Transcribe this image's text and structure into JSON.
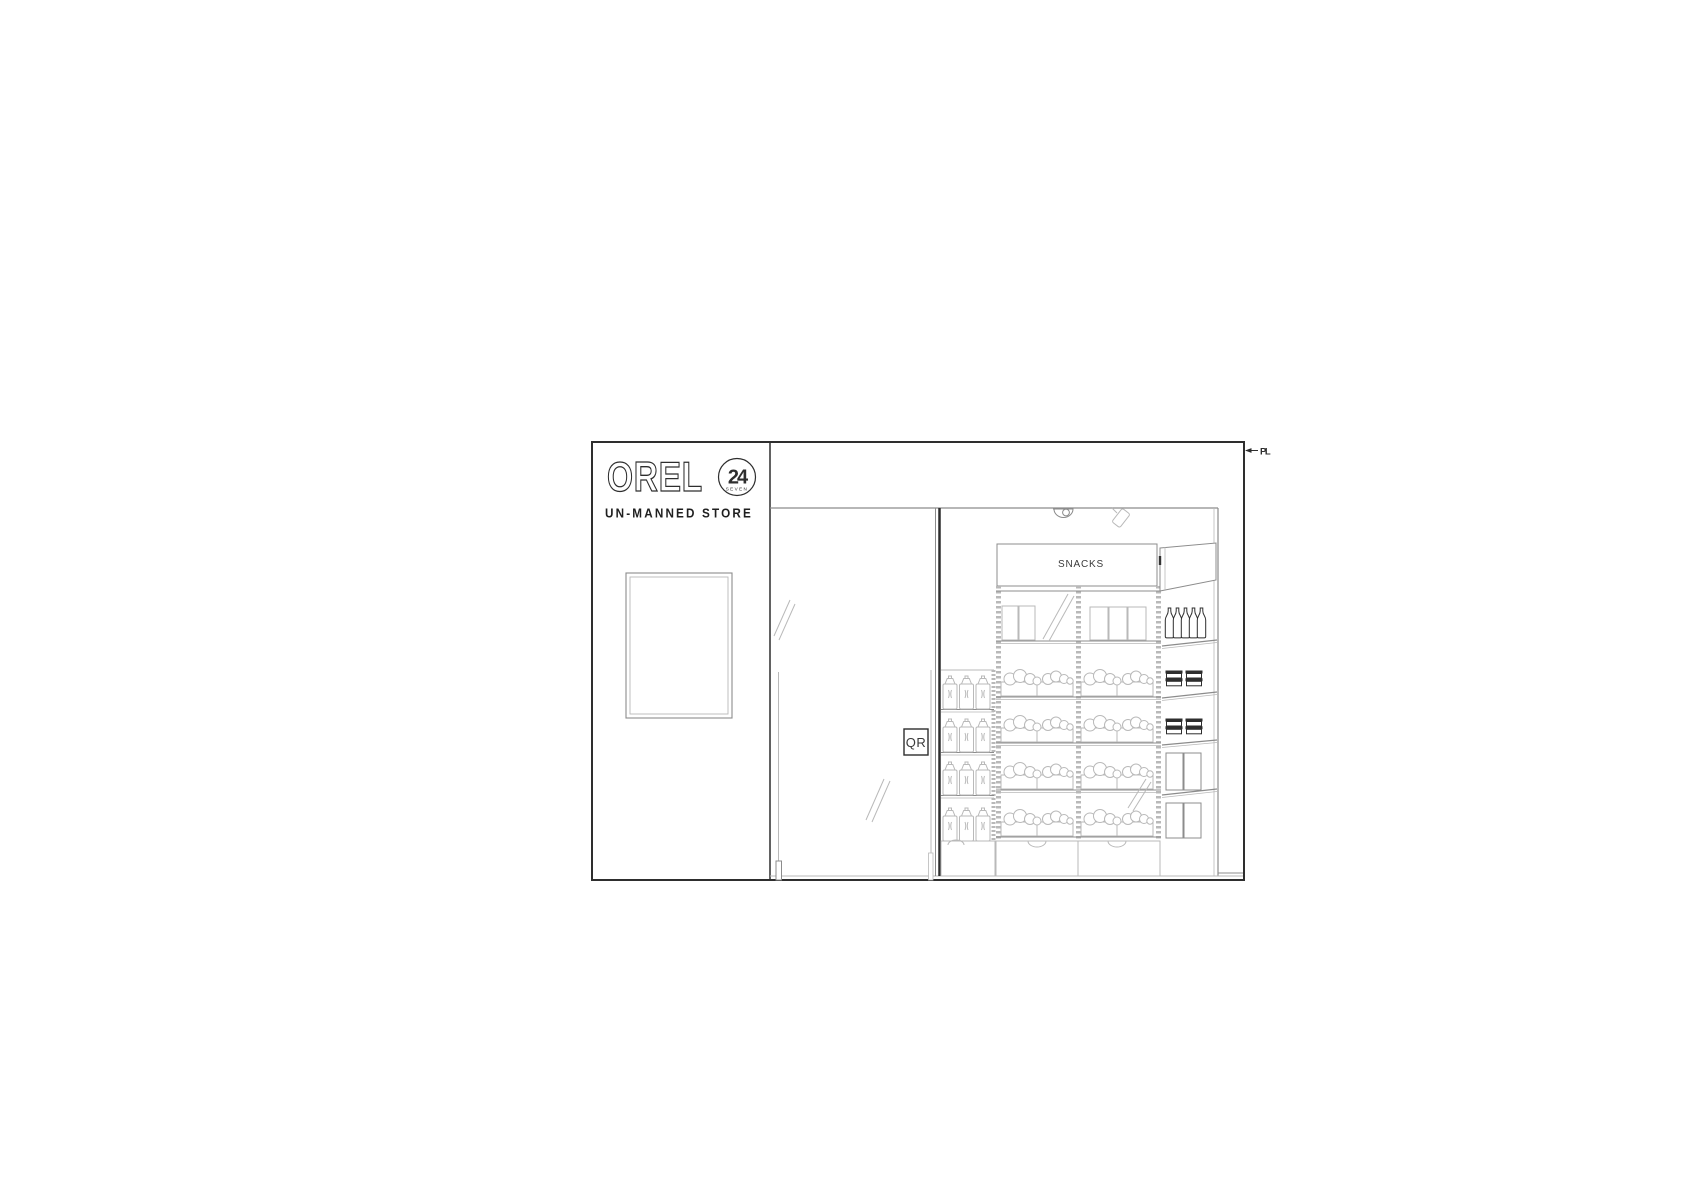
{
  "sign_panel": {
    "brand": "OREL",
    "badge": {
      "number": "24",
      "caption": "SEVEN"
    },
    "subtitle": "UN-MANNED STORE"
  },
  "interior": {
    "snacks_sign": "SNACKS",
    "qr_sign": "QR"
  },
  "annotations": {
    "property_line": "PL"
  },
  "colors": {
    "line_dark": "#2e2e2e",
    "line_mid": "#8c8c8c",
    "line_light": "#b9b9b9",
    "background": "#ffffff"
  }
}
